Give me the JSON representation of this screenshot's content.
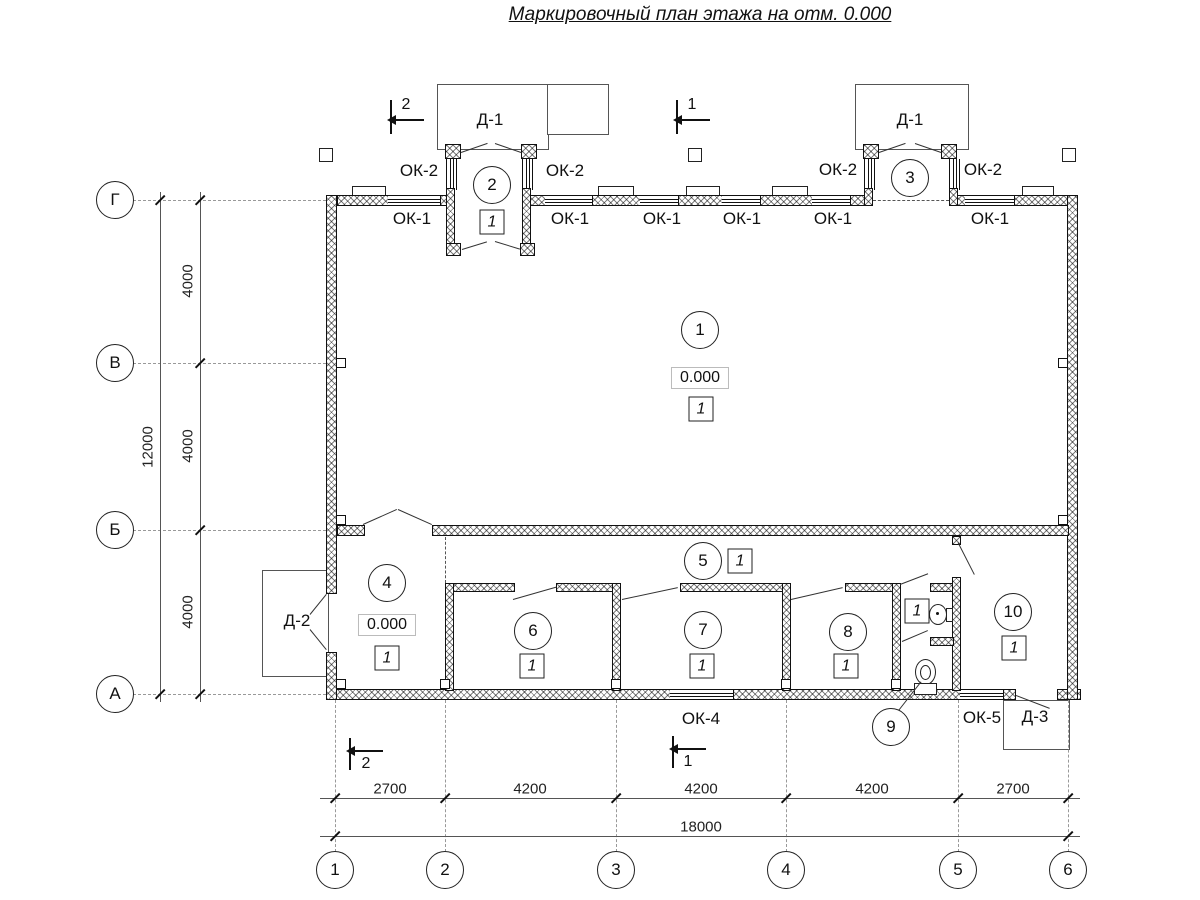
{
  "title": "Маркировочный план этажа на отм. 0.000",
  "axes": {
    "left": [
      "Г",
      "В",
      "Б",
      "А"
    ],
    "bottom": [
      "1",
      "2",
      "3",
      "4",
      "5",
      "6"
    ]
  },
  "dims": {
    "bottom_segments": [
      "2700",
      "4200",
      "4200",
      "4200",
      "2700"
    ],
    "bottom_total": "18000",
    "left_segments": [
      "4000",
      "4000",
      "4000"
    ],
    "left_total": "12000"
  },
  "sections": {
    "top_left": "2",
    "top_center": "1",
    "bottom_left": "2",
    "bottom_center": "1"
  },
  "doors": {
    "d1_left": "Д-1",
    "d1_right": "Д-1",
    "d2": "Д-2",
    "d3": "Д-3"
  },
  "windows": {
    "ok1": [
      "ОК-1",
      "ОК-1",
      "ОК-1",
      "ОК-1",
      "ОК-1",
      "ОК-1"
    ],
    "ok2": [
      "ОК-2",
      "ОК-2",
      "ОК-2",
      "ОК-2"
    ],
    "ok4": "ОК-4",
    "ok5": "ОК-5"
  },
  "rooms": {
    "hall": {
      "num": "1",
      "elev": "0.000",
      "floor": "1"
    },
    "vestibule_left": {
      "num": "2",
      "floor": "1"
    },
    "vestibule_right": {
      "num": "3"
    },
    "room4": {
      "num": "4",
      "elev": "0.000",
      "floor": "1"
    },
    "corridor": {
      "num": "5",
      "floor": "1"
    },
    "room6": {
      "num": "6",
      "floor": "1"
    },
    "room7": {
      "num": "7",
      "floor": "1"
    },
    "room8": {
      "num": "8",
      "floor": "1"
    },
    "washroom": {
      "floor": "1"
    },
    "wc": {
      "num": "9"
    },
    "room10": {
      "num": "10",
      "floor": "1"
    }
  }
}
